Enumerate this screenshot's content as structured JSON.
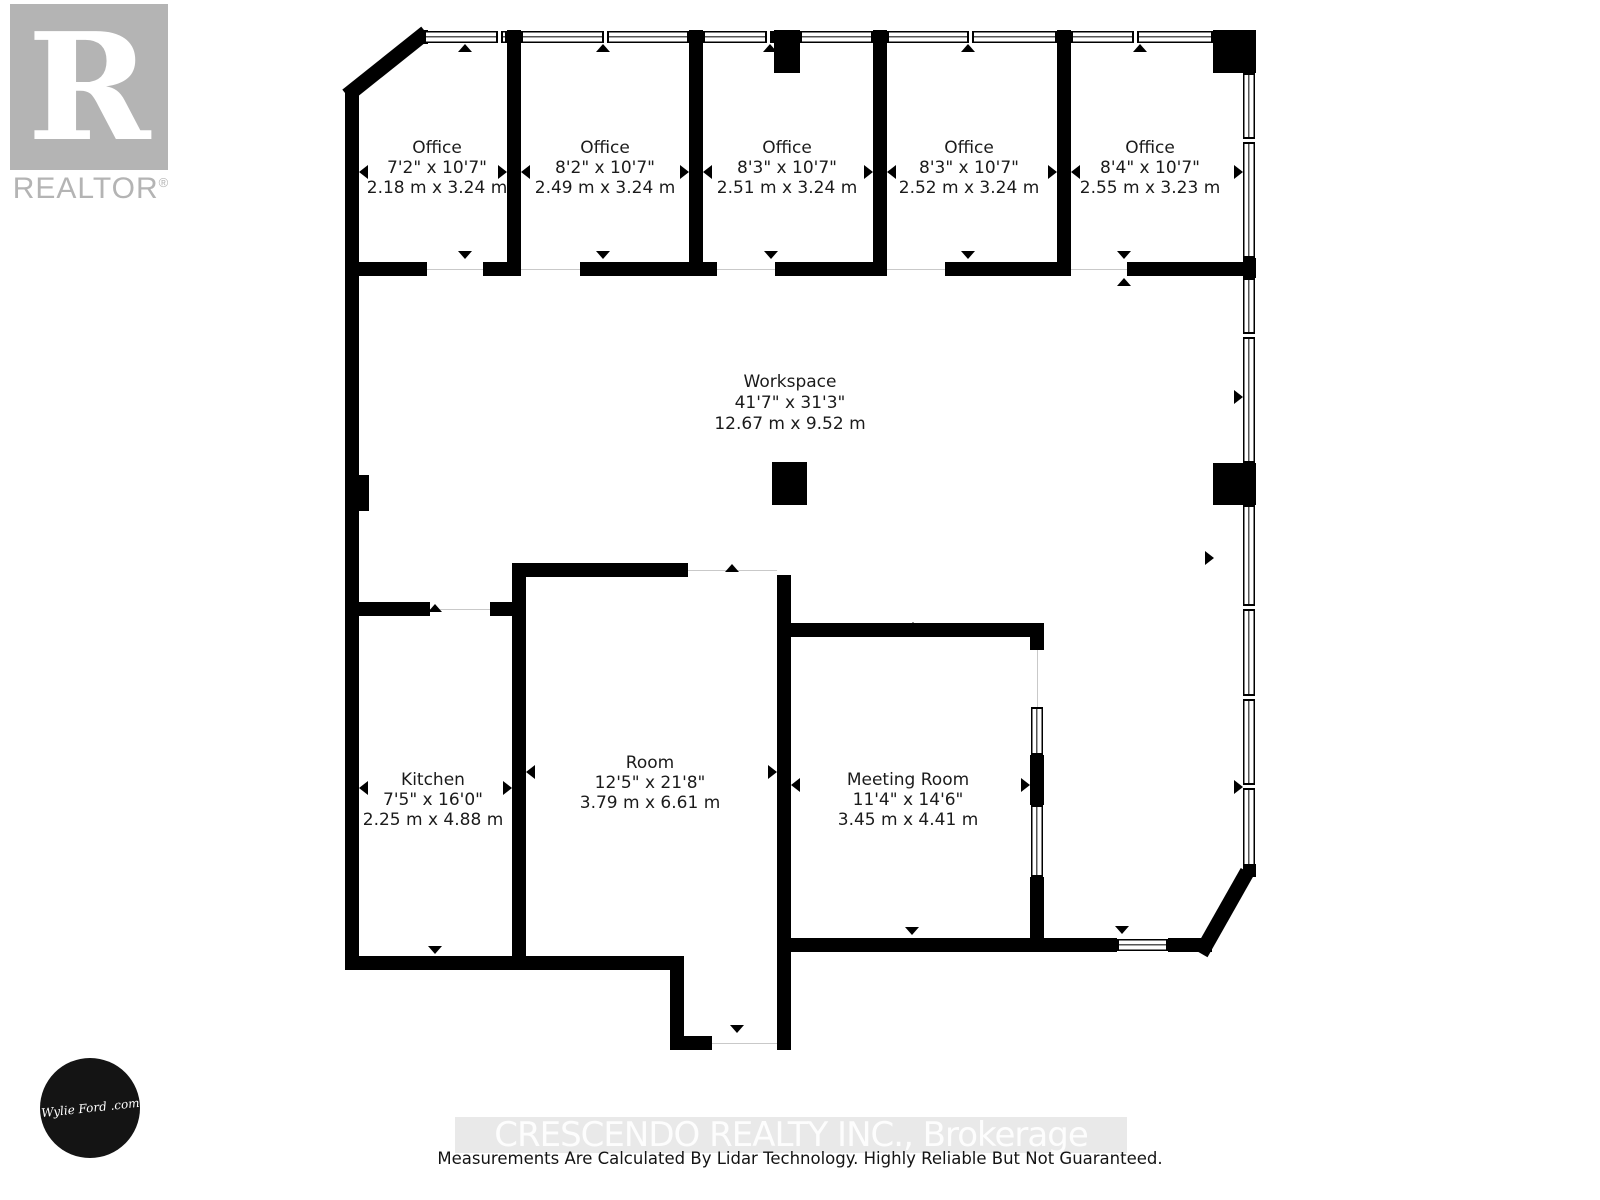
{
  "branding": {
    "realtor_r": "R",
    "realtor_wordmark": "REALTOR",
    "registered_mark": "®",
    "agent_signature": "Wylie Ford .com"
  },
  "rooms": {
    "office1": {
      "name": "Office",
      "imperial": "7'2\" x 10'7\"",
      "metric": "2.18 m x 3.24 m"
    },
    "office2": {
      "name": "Office",
      "imperial": "8'2\" x 10'7\"",
      "metric": "2.49 m x 3.24 m"
    },
    "office3": {
      "name": "Office",
      "imperial": "8'3\" x 10'7\"",
      "metric": "2.51 m x 3.24 m"
    },
    "office4": {
      "name": "Office",
      "imperial": "8'3\" x 10'7\"",
      "metric": "2.52 m x 3.24 m"
    },
    "office5": {
      "name": "Office",
      "imperial": "8'4\" x 10'7\"",
      "metric": "2.55 m x 3.23 m"
    },
    "workspace": {
      "name": "Workspace",
      "imperial": "41'7\" x 31'3\"",
      "metric": "12.67 m x 9.52 m"
    },
    "kitchen": {
      "name": "Kitchen",
      "imperial": "7'5\" x 16'0\"",
      "metric": "2.25 m x 4.88 m"
    },
    "room": {
      "name": "Room",
      "imperial": "12'5\" x 21'8\"",
      "metric": "3.79 m x 6.61 m"
    },
    "meeting_room": {
      "name": "Meeting Room",
      "imperial": "11'4\" x 14'6\"",
      "metric": "3.45 m x 4.41 m"
    }
  },
  "footer": {
    "watermark": "CRESCENDO REALTY INC., Brokerage",
    "disclaimer": "Measurements Are Calculated By Lidar Technology. Highly Reliable But Not Guaranteed."
  }
}
